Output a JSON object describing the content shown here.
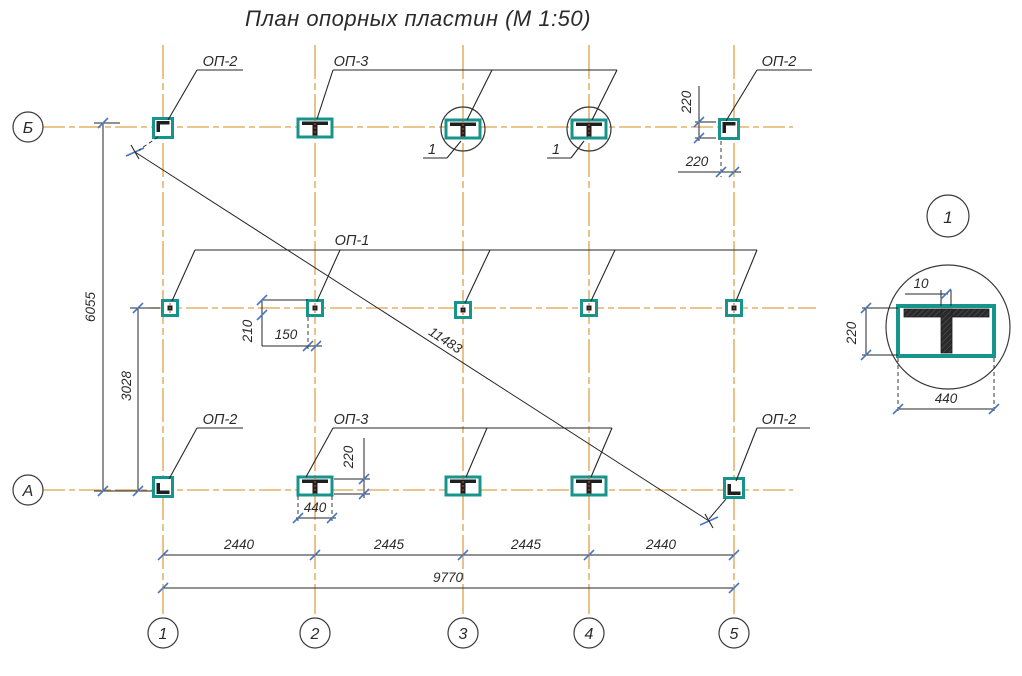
{
  "title": "План опорных пластин (М 1:50)",
  "colors": {
    "grid_axis": "#dda24b",
    "plate_teal": "#17948c",
    "dimension_tick": "#4a77c4",
    "line_dark": "#262626",
    "steel_hatch": "#2a2a2a"
  },
  "axes": {
    "cols": [
      "1",
      "2",
      "3",
      "4",
      "5"
    ],
    "rows": [
      "Б",
      "А"
    ]
  },
  "labels": {
    "op2_top_left": "ОП-2",
    "op3_top": "ОП-3",
    "op2_top_right": "ОП-2",
    "op1_mid": "ОП-1",
    "op2_bot_left": "ОП-2",
    "op3_bot": "ОП-3",
    "op2_bot_right": "ОП-2",
    "callout": "1"
  },
  "dims": {
    "spans": [
      "2440",
      "2445",
      "2445",
      "2440"
    ],
    "total_w": "9770",
    "total_h": "6055",
    "lower_h": "3028",
    "diagonal": "11483",
    "tr_v": "220",
    "tr_h": "220",
    "mid_v": "210",
    "mid_h": "150",
    "bot_v": "220",
    "bot_w": "440"
  },
  "detail": {
    "ref": "1",
    "stem_w": "10",
    "h": "220",
    "w": "440"
  }
}
